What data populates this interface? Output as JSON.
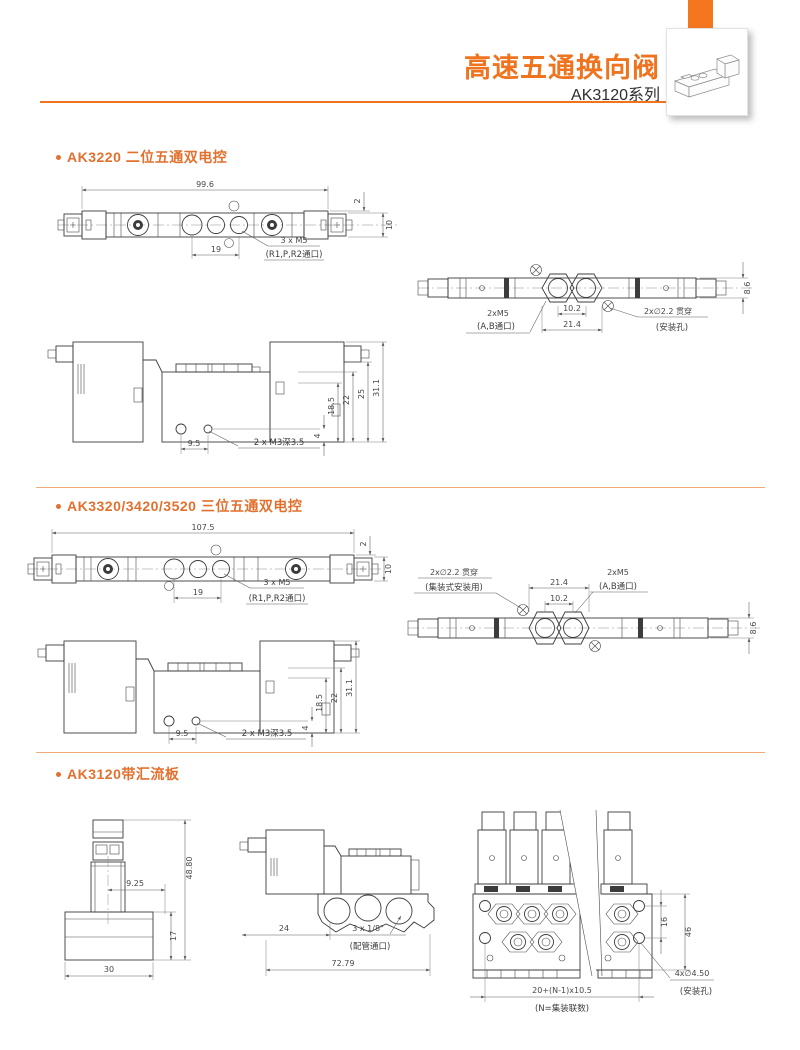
{
  "header": {
    "title": "高速五通换向阀",
    "series": "AK3120系列",
    "accent_color": "#ef7420"
  },
  "section1": {
    "title": "AK3220 二位五通双电控",
    "top_view": {
      "overall_width": "99.6",
      "port_pitch": "19",
      "ports_label": "3 x M5",
      "ports_note": "(R1,P,R2通口)",
      "edge_offset": "2",
      "body_height": "10"
    },
    "bottom_view": {
      "thread_label": "2xM5",
      "thread_note": "(A,B通口)",
      "port_pitch": "10.2",
      "port_span": "21.4",
      "hole_label": "2x∅2.2 贯穿",
      "hole_note": "(安装孔)",
      "body_height": "8.6"
    },
    "side_view": {
      "height_1": "18.5",
      "height_2": "22",
      "height_3": "25",
      "height_4": "31.1",
      "hole_offset": "4",
      "hole_pitch": "9.5",
      "tap_label": "2 x M3深3.5"
    }
  },
  "section2": {
    "title": "AK3320/3420/3520 三位五通双电控",
    "top_view": {
      "overall_width": "107.5",
      "port_pitch": "19",
      "ports_label": "3 x M5",
      "ports_note": "(R1,P,R2通口)",
      "edge_offset": "2",
      "body_height": "10"
    },
    "bottom_view": {
      "hole_label": "2x∅2.2 贯穿",
      "hole_note": "(集装式安装用)",
      "port_span": "21.4",
      "port_pitch": "10.2",
      "thread_label": "2xM5",
      "thread_note": "(A,B通口)",
      "body_height": "8.6"
    },
    "side_view": {
      "height_1": "18.5",
      "height_2": "22",
      "height_3": "31.1",
      "hole_offset": "4",
      "hole_pitch": "9.5",
      "tap_label": "2 x M3深3.5"
    }
  },
  "section3": {
    "title": "AK3120带汇流板",
    "end_view": {
      "overall_height": "48.80",
      "center_offset": "9.25",
      "base_height": "17",
      "base_width": "30"
    },
    "side_view": {
      "left_offset": "24",
      "ports_label": "3 x 1/8\"",
      "ports_note": "(配管通口)",
      "overall_length": "72.79"
    },
    "front_view": {
      "hole_pitch": "16",
      "overall_height": "46",
      "length_formula": "20+(N-1)x10.5",
      "formula_note": "(N=集装联数)",
      "mount_label": "4x∅4.50",
      "mount_note": "(安装孔)"
    }
  }
}
